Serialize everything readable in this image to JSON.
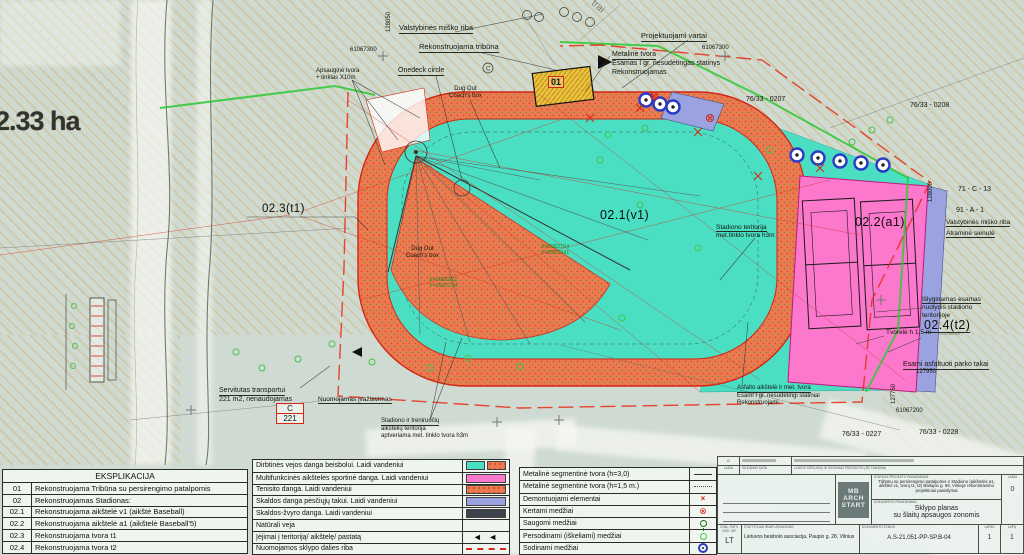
{
  "palette": {
    "field_teal": "#4adfc2",
    "infield_orange": "#ee7950",
    "courts_pink": "#fb78cc",
    "path_violet": "#9aa3e0",
    "tribune_yellow": "#eec33e",
    "boundary_red": "#e8321e",
    "forest_green": "#35c93c",
    "background_green": "#cfdbd2"
  },
  "map": {
    "area_label": "2.33 ha",
    "zones": {
      "tribune": "01",
      "field": "02.1(v1)",
      "courts": "02.2(a1)",
      "fence_t1": "02.3(t1)",
      "fence_t2": "02.4(t2)"
    },
    "labels": {
      "forest_boundary_top": "Valstybinės miško riba",
      "reconstructed_tribune": "Rekonstruojama tribūna",
      "ondeck_circle": "Onedeck circle",
      "dugout_line1": "Dug Out",
      "dugout_line2": "Coach's box",
      "projected_gates": "Projektuojami vartai",
      "metal_fence": "Metalinė tvora",
      "existing_simple_building": "Esamas I gr. nesudėtingas statinys",
      "being_reconstructed": "Rekonstruojamas",
      "protective_fence_line1": "Apsauginė tvora",
      "protective_fence_line2": "+ tinklas X10m",
      "stadium_fence_line1": "Stadiono teritorija",
      "stadium_fence_line2": "met.tinklo tvora h3m",
      "leveling_line1": "Išlyginamas esamas",
      "leveling_line2": "nuolydis stadiono",
      "leveling_line3": "teritorijoje",
      "low_fence": "Tvorelė h 1,5 m",
      "park_paths": "Esami asfaltuoti parko takai",
      "forest_boundary_right": "Valstybinės miško riba",
      "retaining_wall": "Atraminė sienutė",
      "servitude_line1": "Servitutas transportui",
      "servitude_line2": "221 m2, nenaudojamas",
      "training_fence_line1": "Stadiono ir treniruočių",
      "training_fence_line2": "aikštelių teritorija",
      "training_fence_line3": "aptveriama met. tinklo tvora h3m",
      "rented_driveway": "Nuomojamas įvažiavimas",
      "asphalt_line1": "Asfalto aikštelė ir met. tvora",
      "asphalt_line2": "Esami I gr. nesudėtingi statiniai",
      "asphalt_line3": "Rekonstruojami",
      "street_fragment": "trai",
      "marker_c": "C"
    },
    "survey_box": {
      "top": "C",
      "bottom": "221"
    },
    "parcels": {
      "p1": "76/33 - 0207",
      "p2": "76/33 - 0208",
      "p3": "71 - C - 13",
      "p4": "91 - A - 1",
      "p5": "76/33 - 0227",
      "p6": "76/33 - 0228"
    },
    "coords": {
      "c1": "128050",
      "c2": "61067300",
      "c3": "61067300",
      "c4": "128000",
      "c5": "61067200",
      "c6": "127950",
      "c7": "127750"
    },
    "geo": {
      "x1": "X=6081921",
      "y1": "Y=2587724",
      "x2": "X=6082154",
      "y2": "Y=2587241"
    }
  },
  "explication": {
    "title": "EKSPLIKACIJA",
    "rows": [
      {
        "code": "01",
        "text": "Rekonstruojama  Tribūna su persirengimo patalpomis"
      },
      {
        "code": "02",
        "text": "Rekonstruojamas Stadionas:"
      },
      {
        "code": "02.1",
        "text": "Rekonstruojama aikštelė v1 (aikštė Baseball)"
      },
      {
        "code": "02.2",
        "text": "Rekonstruojama aikštelė a1 (aikštelė Baseball'5)"
      },
      {
        "code": "02.3",
        "text": "Rekonstruojama tvora t1"
      },
      {
        "code": "02.4",
        "text": "Rekonstruojama tvora t2"
      }
    ]
  },
  "surfaces": {
    "rows": [
      {
        "label": "Dirbtinės vejos danga beisbolui. Laidi vandeniui",
        "swatch": "teal-and-orange"
      },
      {
        "label": "Multifunkcinės aikštelės sportinė danga. Laidi vandeniui",
        "swatch": "pink"
      },
      {
        "label": "Tenisito danga. Laidi vandeniui",
        "swatch": "orange"
      },
      {
        "label": "Skaldos danga pėsčiųjų takui. Laidi vandeniui",
        "swatch": "violet"
      },
      {
        "label": "Skaldos-žvyro danga. Laidi vandeniui",
        "swatch": "dark-gray"
      },
      {
        "label": "Natūrali veja",
        "swatch": "none"
      },
      {
        "label": "Įėjimai į teritoriją/ aikštelę/ pastatą",
        "swatch": "black-arrows"
      },
      {
        "label": "Nuomojamos sklypo dalies riba",
        "swatch": "red-dash"
      }
    ],
    "arrows_glyph": "◄ ◄"
  },
  "symbols": {
    "rows": [
      {
        "label": "Metalinė segmentinė tvora (h=3,0)",
        "symbol": "solid-line"
      },
      {
        "label": "Metalinė segmentinė tvora (h=1,5 m.)",
        "symbol": "dotted-line"
      },
      {
        "label": "Demontuojami elementai",
        "symbol": "red-x"
      },
      {
        "label": "Kertami medžiai",
        "symbol": "red-circle-x"
      },
      {
        "label": "Saugomi medžiai",
        "symbol": "tree"
      },
      {
        "label": "Persodinami (iškeliami) medžiai",
        "symbol": "green-circle"
      },
      {
        "label": "Sodinami medžiai",
        "symbol": "blue-circle-dot"
      }
    ],
    "red_x_glyph": "×",
    "red_circle_x_glyph": "⊗"
  },
  "titleblock": {
    "rev_value": "0",
    "rev_label": "LAIDA",
    "date_label": "IŠLEIDIMO DATA",
    "status_label": "LAIDOS STATUSAS IR IŠLEIDIMO PRIEŽASTIS (JEI TAIKOMA)",
    "logo_line1": "MB",
    "logo_line2": "ARCH",
    "logo_line3": "START",
    "project_label": "STATINIO PROJEKTO PAVADINIMAS",
    "project_title": "Tribūnų su persirengimo patalpomis ir Stadiono (aikštelės a1, aikštės v1, tvorų t1, t2) Baltupio g. 69, Vilniuje rekonstravimo projektiniai pasiūlymai",
    "doc_label": "DOKUMENTO PAVADINIMAS",
    "doc_title_line1": "Sklypo planas",
    "doc_title_line2": "su šlaitų apsaugos zonomis",
    "laida_label": "LAIDA",
    "laida_value": "0",
    "kval_label": "KVAL. PATV. DOK. NR.",
    "lang": "LT",
    "client_label": "STATYTOJAS IR/AR UŽSAKOVAS",
    "client": "Lietuvos beisbolo asociacija, Paupio g. 28, Vilnius",
    "docnum_label": "DOKUMENTO ŽYMUO",
    "docnum": "A.S-21.051-PP-SP.B-04",
    "sheet_label": "LAPAS",
    "sheet_value": "1",
    "sheets_label": "LAPŲ",
    "sheets_value": "1"
  }
}
